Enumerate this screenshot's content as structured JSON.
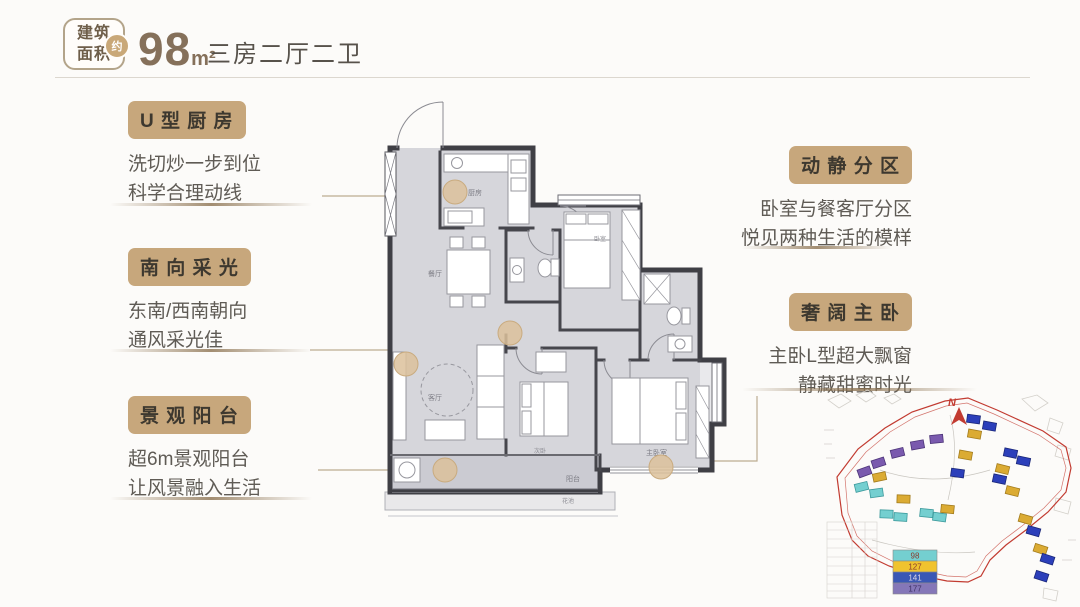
{
  "header": {
    "badge_line1": "建筑",
    "badge_line2": "面积",
    "approx_label": "约",
    "area_value": "98",
    "area_unit": "m²",
    "layout_text": "三房二厅二卫"
  },
  "features": [
    {
      "title": "U 型 厨 房",
      "line1": "洗切炒一步到位",
      "line2": "科学合理动线"
    },
    {
      "title": "南 向 采 光",
      "line1": "东南/西南朝向",
      "line2": "通风采光佳"
    },
    {
      "title": "景 观 阳 台",
      "line1": "超6m景观阳台",
      "line2": "让风景融入生活"
    },
    {
      "title": "动 静 分 区",
      "line1": "卧室与餐客厅分区",
      "line2": "悦见两种生活的模样"
    },
    {
      "title": "奢 阔 主 卧",
      "line1": "主卧L型超大飘窗",
      "line2": "静藏甜蜜时光"
    }
  ],
  "floor_plan": {
    "rooms": {
      "kitchen": "厨房",
      "dining": "餐厅",
      "living": "客厅",
      "bedroom": "卧室",
      "bedroom2": "次卧",
      "master": "主卧室",
      "balcony": "阳台",
      "flower_bed": "花池"
    }
  },
  "site_map": {
    "north_label": "N",
    "legend": [
      {
        "color": "#74cfd0",
        "value": "98"
      },
      {
        "color": "#f0c32f",
        "value": "127"
      },
      {
        "color": "#3a57b5",
        "value": "141"
      },
      {
        "color": "#8577b8",
        "value": "177"
      }
    ]
  },
  "colors": {
    "accent_tan": "#c7a77c",
    "number_brown": "#85705a",
    "text_gray": "#5f5b55",
    "boundary_red": "#c23b31",
    "marker_tan": "#dcc19b"
  }
}
